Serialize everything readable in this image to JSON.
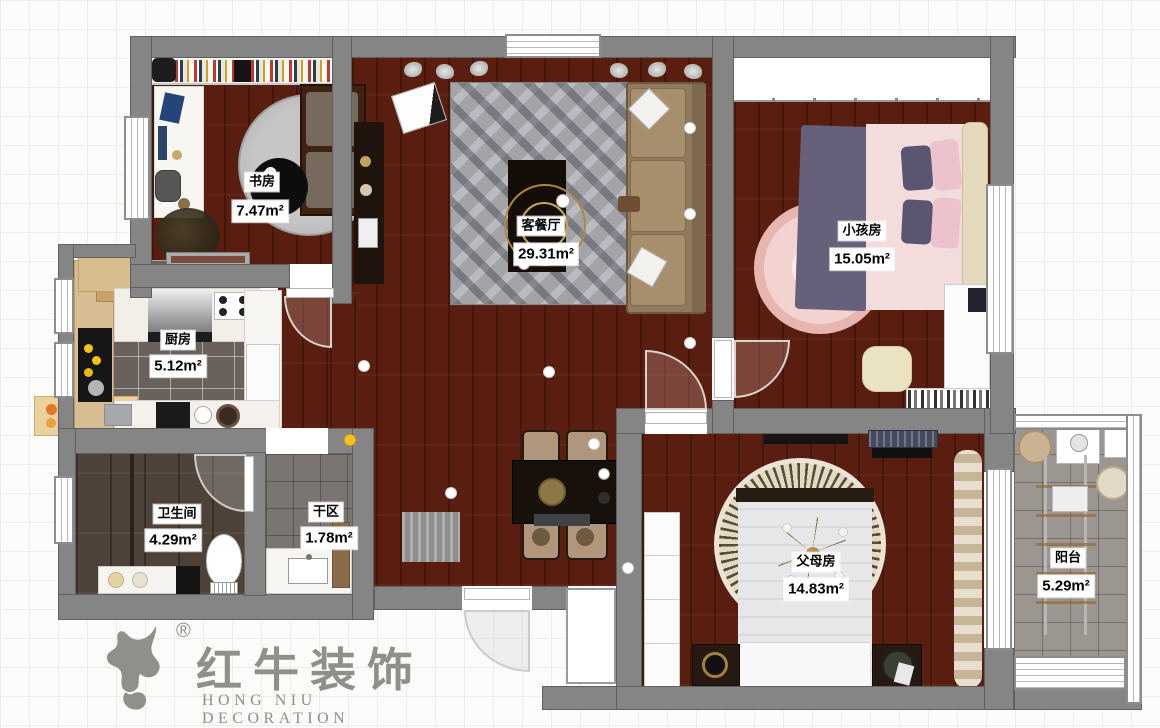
{
  "rooms": [
    {
      "name": "书房",
      "area": "7.47m²"
    },
    {
      "name": "客餐厅",
      "area": "29.31m²"
    },
    {
      "name": "小孩房",
      "area": "15.05m²"
    },
    {
      "name": "厨房",
      "area": "5.12m²"
    },
    {
      "name": "卫生间",
      "area": "4.29m²"
    },
    {
      "name": "干区",
      "area": "1.78m²"
    },
    {
      "name": "父母房",
      "area": "14.83m²"
    },
    {
      "name": "阳台",
      "area": "5.29m²"
    }
  ],
  "logo": {
    "brand": "红牛装饰",
    "subtitle": "HONG NIU DECORATION",
    "registered": "®"
  },
  "colors": {
    "wood_floor": "#591e10",
    "wall": "#858585",
    "accent_gold": "#ab8a40",
    "kids_pink": "#e7b6b0",
    "label_bg": "#ffffff"
  }
}
